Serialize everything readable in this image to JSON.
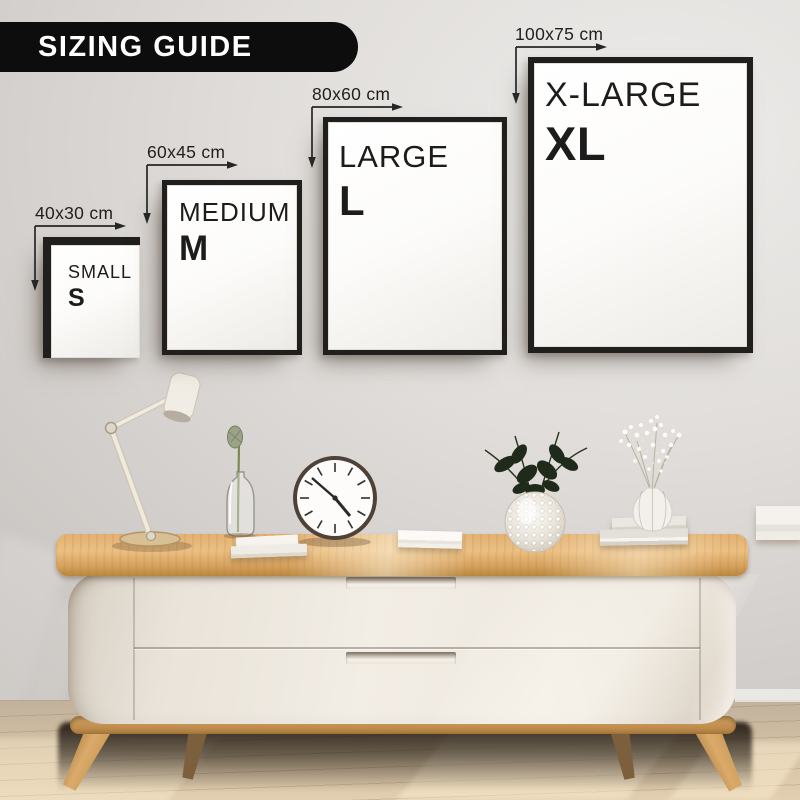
{
  "banner": {
    "label": "SIZING GUIDE",
    "background": "#0d0d0d",
    "text_color": "#ffffff"
  },
  "frames": [
    {
      "name": "SMALL",
      "abbr": "S",
      "dimensions": "40x30 cm"
    },
    {
      "name": "MEDIUM",
      "abbr": "M",
      "dimensions": "60x45 cm"
    },
    {
      "name": "LARGE",
      "abbr": "L",
      "dimensions": "80x60 cm"
    },
    {
      "name": "X-LARGE",
      "abbr": "XL",
      "dimensions": "100x75 cm"
    }
  ],
  "colors": {
    "wall": "#d8d5d1",
    "frame_border": "#211f1d",
    "poster": "#fbfaf8",
    "label_text": "#1c1c1c",
    "wood": "#ddab69",
    "cabinet_body": "#ece6dd",
    "floor": "#d2c0a6",
    "shadow": "#21190f"
  },
  "decor_items": [
    "desk-lamp",
    "flower-bottle",
    "wall-clock",
    "stacked-books",
    "bubble-glass-vase",
    "white-vase-with-flowers"
  ]
}
